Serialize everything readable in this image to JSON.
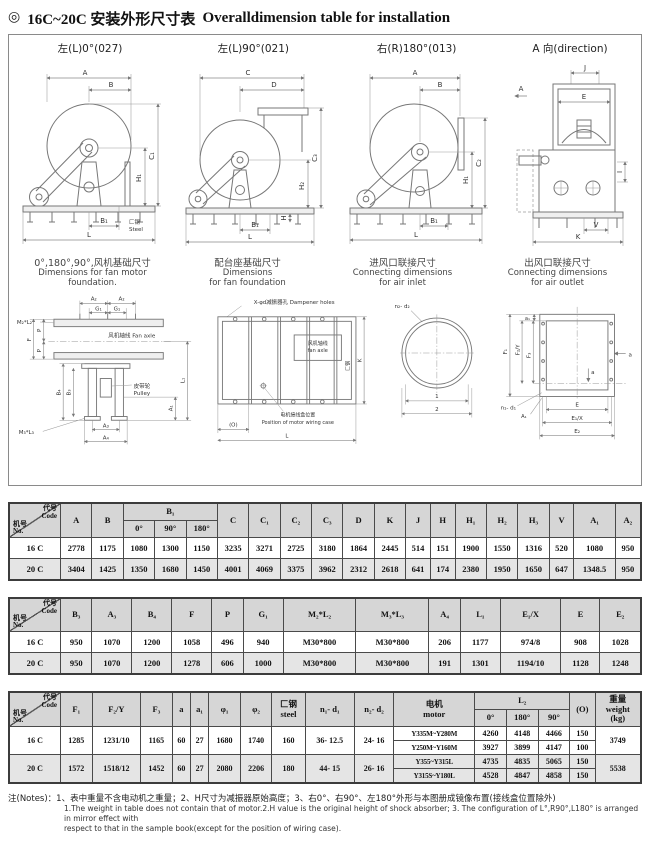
{
  "page": {
    "bullet": "◎",
    "title_zh": "16C~20C 安装外形尺寸表",
    "title_en": "Overalldimension table for installation"
  },
  "drawings": {
    "d1": {
      "title": "左(L)0°(027)",
      "labels": {
        "A": "A",
        "B": "B",
        "C1": "C₁",
        "H1": "H₁",
        "B1": "B₁",
        "L": "L",
        "steel": "匚钢",
        "steel_en": "Steel"
      }
    },
    "d2": {
      "title": "左(L)90°(021)",
      "labels": {
        "C": "C",
        "D": "D",
        "C3": "C₃",
        "H2": "H₂",
        "H": "H",
        "B1": "B₁",
        "L": "L"
      }
    },
    "d3": {
      "title": "右(R)180°(013)",
      "labels": {
        "A": "A",
        "B": "B",
        "C2": "C₂",
        "H1": "H₁",
        "B1": "B₁",
        "L": "L"
      }
    },
    "d4": {
      "title": "A 向(direction)",
      "labels": {
        "J": "J",
        "E": "E",
        "A": "A",
        "I": "I",
        "V": "V",
        "K": "K"
      }
    },
    "captions": [
      {
        "zh": "0°,180°,90°,风机基础尺寸",
        "en": "Dimensions for fan motor foundation."
      },
      {
        "zh": "配台座基础尺寸",
        "en": "Dimensions\nfor fan foundation"
      },
      {
        "zh": "进风口联接尺寸",
        "en": "Connecting dimensions\nfor air inlet"
      },
      {
        "zh": "出风口联接尺寸",
        "en": "Connecting dimensions\nfor air outlet"
      }
    ],
    "d5": {
      "labels": {
        "M2L2": "M₂*L₂",
        "A2a": "A₂",
        "A2b": "A₂",
        "G1a": "G₁",
        "G1b": "G₁",
        "axle": "风机轴线 Fan axle",
        "F": "F",
        "Pa": "P",
        "Pb": "P",
        "B4": "B₄",
        "B3": "B₃",
        "M3L3": "M₃*L₃",
        "A3": "A₃",
        "A4": "A₄",
        "pulley_zh": "皮带轮",
        "pulley_en": "Pulley",
        "A1": "A₁",
        "L1": "L₁"
      }
    },
    "d6": {
      "labels": {
        "damp": "X-φd减振器孔 Dampener holes",
        "axle_zh": "风机轴线",
        "axle_en": "fan axle",
        "wiring_zh": "电机接线盒位置",
        "wiring_en": "Position of motor wiring case",
        "O": "(O)",
        "L": "L",
        "K": "K",
        "steel": "匚钢"
      }
    },
    "d7": {
      "labels": {
        "n2d2": "n₂- d₂",
        "one": "1",
        "two": "2"
      }
    },
    "d8": {
      "labels": {
        "a1": "a₁",
        "F1": "F₁",
        "F2Y": "F₂/Y",
        "F3": "F₃",
        "aa": "a",
        "ab": "a",
        "n1d1": "n₁- d₁",
        "A1": "A₁",
        "E": "E",
        "E1X": "E₁/X",
        "E2": "E₂"
      }
    }
  },
  "tables": [
    {
      "corner": {
        "top": "代号\nCode",
        "bottom": "机号\nNo."
      },
      "header": [
        [
          {
            "t": "A",
            "rs": 2
          },
          {
            "t": "B",
            "rs": 2
          },
          {
            "t": "B₁",
            "cs": 3
          },
          {
            "t": "C",
            "rs": 2
          },
          {
            "t": "C₁",
            "rs": 2
          },
          {
            "t": "C₂",
            "rs": 2
          },
          {
            "t": "C₃",
            "rs": 2
          },
          {
            "t": "D",
            "rs": 2
          },
          {
            "t": "K",
            "rs": 2
          },
          {
            "t": "J",
            "rs": 2
          },
          {
            "t": "H",
            "rs": 2
          },
          {
            "t": "H₁",
            "rs": 2
          },
          {
            "t": "H₂",
            "rs": 2
          },
          {
            "t": "H₃",
            "rs": 2
          },
          {
            "t": "V",
            "rs": 2
          },
          {
            "t": "A₁",
            "rs": 2
          },
          {
            "t": "A₂",
            "rs": 2
          }
        ],
        [
          {
            "t": "0°"
          },
          {
            "t": "90°"
          },
          {
            "t": "180°"
          }
        ]
      ],
      "body": [
        {
          "shaded": false,
          "cells": [
            {
              "t": "16 C",
              "h": 1
            },
            {
              "t": "2778"
            },
            {
              "t": "1175"
            },
            {
              "t": "1080"
            },
            {
              "t": "1300"
            },
            {
              "t": "1150"
            },
            {
              "t": "3235"
            },
            {
              "t": "3271"
            },
            {
              "t": "2725"
            },
            {
              "t": "3180"
            },
            {
              "t": "1864"
            },
            {
              "t": "2445"
            },
            {
              "t": "514"
            },
            {
              "t": "151"
            },
            {
              "t": "1900"
            },
            {
              "t": "1550"
            },
            {
              "t": "1316"
            },
            {
              "t": "520"
            },
            {
              "t": "1080"
            },
            {
              "t": "950"
            }
          ]
        },
        {
          "shaded": true,
          "cells": [
            {
              "t": "20 C",
              "h": 1
            },
            {
              "t": "3404"
            },
            {
              "t": "1425"
            },
            {
              "t": "1350"
            },
            {
              "t": "1680"
            },
            {
              "t": "1450"
            },
            {
              "t": "4001"
            },
            {
              "t": "4069"
            },
            {
              "t": "3375"
            },
            {
              "t": "3962"
            },
            {
              "t": "2312"
            },
            {
              "t": "2618"
            },
            {
              "t": "641"
            },
            {
              "t": "174"
            },
            {
              "t": "2380"
            },
            {
              "t": "1950"
            },
            {
              "t": "1650"
            },
            {
              "t": "647"
            },
            {
              "t": "1348.5"
            },
            {
              "t": "950"
            }
          ]
        }
      ]
    },
    {
      "corner": {
        "top": "代号\nCode",
        "bottom": "机号\nNo."
      },
      "header": [
        [
          {
            "t": "B₃"
          },
          {
            "t": "A₃"
          },
          {
            "t": "B₄"
          },
          {
            "t": "F"
          },
          {
            "t": "P"
          },
          {
            "t": "G₁"
          },
          {
            "t": "M₂*L₂"
          },
          {
            "t": "M₃*L₃"
          },
          {
            "t": "A₄"
          },
          {
            "t": "L₁"
          },
          {
            "t": "E₁/X"
          },
          {
            "t": "E"
          },
          {
            "t": "E₂"
          }
        ]
      ],
      "body": [
        {
          "shaded": false,
          "cells": [
            {
              "t": "16 C",
              "h": 1
            },
            {
              "t": "950"
            },
            {
              "t": "1070"
            },
            {
              "t": "1200"
            },
            {
              "t": "1058"
            },
            {
              "t": "496"
            },
            {
              "t": "940"
            },
            {
              "t": "M30*800"
            },
            {
              "t": "M30*800"
            },
            {
              "t": "206"
            },
            {
              "t": "1177"
            },
            {
              "t": "974/8"
            },
            {
              "t": "908"
            },
            {
              "t": "1028"
            }
          ]
        },
        {
          "shaded": true,
          "cells": [
            {
              "t": "20 C",
              "h": 1
            },
            {
              "t": "950"
            },
            {
              "t": "1070"
            },
            {
              "t": "1200"
            },
            {
              "t": "1278"
            },
            {
              "t": "606"
            },
            {
              "t": "1000"
            },
            {
              "t": "M30*800"
            },
            {
              "t": "M30*800"
            },
            {
              "t": "191"
            },
            {
              "t": "1301"
            },
            {
              "t": "1194/10"
            },
            {
              "t": "1128"
            },
            {
              "t": "1248"
            }
          ]
        }
      ]
    },
    {
      "corner": {
        "top": "代号\nCode",
        "bottom": "机号\nNo."
      },
      "header": [
        [
          {
            "t": "F₁",
            "rs": 2
          },
          {
            "t": "F₂/Y",
            "rs": 2
          },
          {
            "t": "F₃",
            "rs": 2
          },
          {
            "t": "a",
            "rs": 2
          },
          {
            "t": "a₁",
            "rs": 2
          },
          {
            "t": "φ₁",
            "rs": 2
          },
          {
            "t": "φ₂",
            "rs": 2
          },
          {
            "t": "匚钢\nsteel",
            "rs": 2
          },
          {
            "t": "n₁- d₁",
            "rs": 2
          },
          {
            "t": "n₂- d₂",
            "rs": 2
          },
          {
            "t": "电机\nmotor",
            "rs": 2
          },
          {
            "t": "L₂",
            "cs": 3
          },
          {
            "t": "(O)",
            "rs": 2
          },
          {
            "t": "重量\nweight\n(kg)",
            "rs": 2
          }
        ],
        [
          {
            "t": "0°"
          },
          {
            "t": "180°"
          },
          {
            "t": "90°"
          }
        ]
      ],
      "body": [
        {
          "shaded": false,
          "cells": [
            {
              "t": "16 C",
              "rs": 2,
              "h": 1
            },
            {
              "t": "1285",
              "rs": 2
            },
            {
              "t": "1231/10",
              "rs": 2
            },
            {
              "t": "1165",
              "rs": 2
            },
            {
              "t": "60",
              "rs": 2
            },
            {
              "t": "27",
              "rs": 2
            },
            {
              "t": "1680",
              "rs": 2
            },
            {
              "t": "1740",
              "rs": 2
            },
            {
              "t": "160",
              "rs": 2
            },
            {
              "t": "36- 12.5",
              "rs": 2
            },
            {
              "t": "24- 16",
              "rs": 2
            },
            {
              "t": "Y335M~Y280M",
              "cls": "sm"
            },
            {
              "t": "4260"
            },
            {
              "t": "4148"
            },
            {
              "t": "4466"
            },
            {
              "t": "150"
            },
            {
              "t": "3749",
              "rs": 2
            }
          ]
        },
        {
          "shaded": false,
          "cells": [
            {
              "t": "Y250M~Y160M",
              "cls": "sm"
            },
            {
              "t": "3927"
            },
            {
              "t": "3899"
            },
            {
              "t": "4147"
            },
            {
              "t": "100"
            }
          ]
        },
        {
          "shaded": true,
          "cells": [
            {
              "t": "20 C",
              "rs": 2,
              "h": 1
            },
            {
              "t": "1572",
              "rs": 2
            },
            {
              "t": "1518/12",
              "rs": 2
            },
            {
              "t": "1452",
              "rs": 2
            },
            {
              "t": "60",
              "rs": 2
            },
            {
              "t": "27",
              "rs": 2
            },
            {
              "t": "2080",
              "rs": 2
            },
            {
              "t": "2206",
              "rs": 2
            },
            {
              "t": "180",
              "rs": 2
            },
            {
              "t": "44- 15",
              "rs": 2
            },
            {
              "t": "26- 16",
              "rs": 2
            },
            {
              "t": "Y355~Y315L",
              "cls": "sm"
            },
            {
              "t": "4735"
            },
            {
              "t": "4835"
            },
            {
              "t": "5065"
            },
            {
              "t": "150"
            },
            {
              "t": "5538",
              "rs": 2
            }
          ]
        },
        {
          "shaded": true,
          "cells": [
            {
              "t": "Y315S~Y180L",
              "cls": "sm"
            },
            {
              "t": "4528"
            },
            {
              "t": "4847"
            },
            {
              "t": "4858"
            },
            {
              "t": "150"
            }
          ]
        }
      ]
    }
  ],
  "notes": {
    "zh": "注(Notes)：1、表中重量不含电动机之重量；2、H尺寸为减振器原始高度；3、右0°、右90°、左180°外形与本图册成镜像布置(接线盒位置除外)",
    "en1": "1.The weight in table does not contain that of motor.2.H value is the original height of shock absorber; 3. The configuration of L°,R90°,L180° is arranged in mirror effect with",
    "en2": "respect to that in the sample book(except for the position of wiring case)."
  }
}
